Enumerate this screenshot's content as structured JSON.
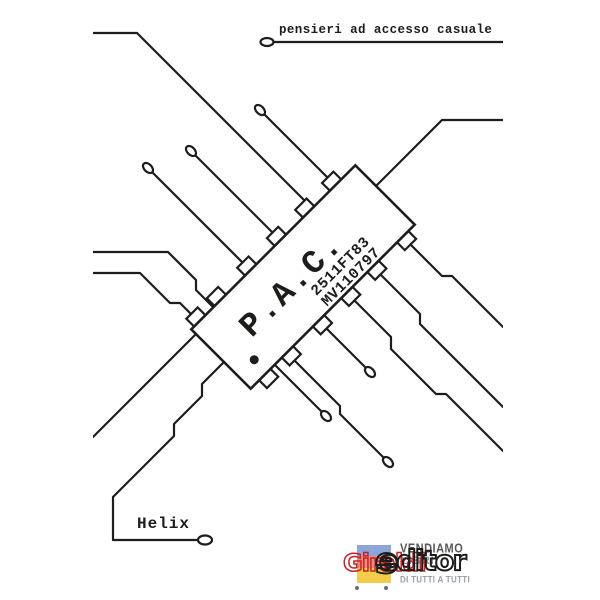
{
  "cover": {
    "title": "pensieri ad accesso casuale",
    "author": "Helix",
    "chip": {
      "label": "P.A.C.",
      "code1": "2511FT83",
      "code2": "MV110797"
    },
    "publisher": {
      "brand_red": "Giraldi",
      "brand_black_main": "editor",
      "brand_black_final": "e",
      "slogan_line1": "VENDIAMO",
      "slogan_line2": "LIBRI",
      "slogan_line3": "DI TUTTI A TUTTI"
    },
    "colors": {
      "ink": "#1d1d1b",
      "brand_red": "#cb2026",
      "bar_blue": "#8ba6d7",
      "bar_salmon": "#e88d7b",
      "bar_yellow": "#f2cd4c",
      "slogan_gray": "#8d9096"
    }
  }
}
